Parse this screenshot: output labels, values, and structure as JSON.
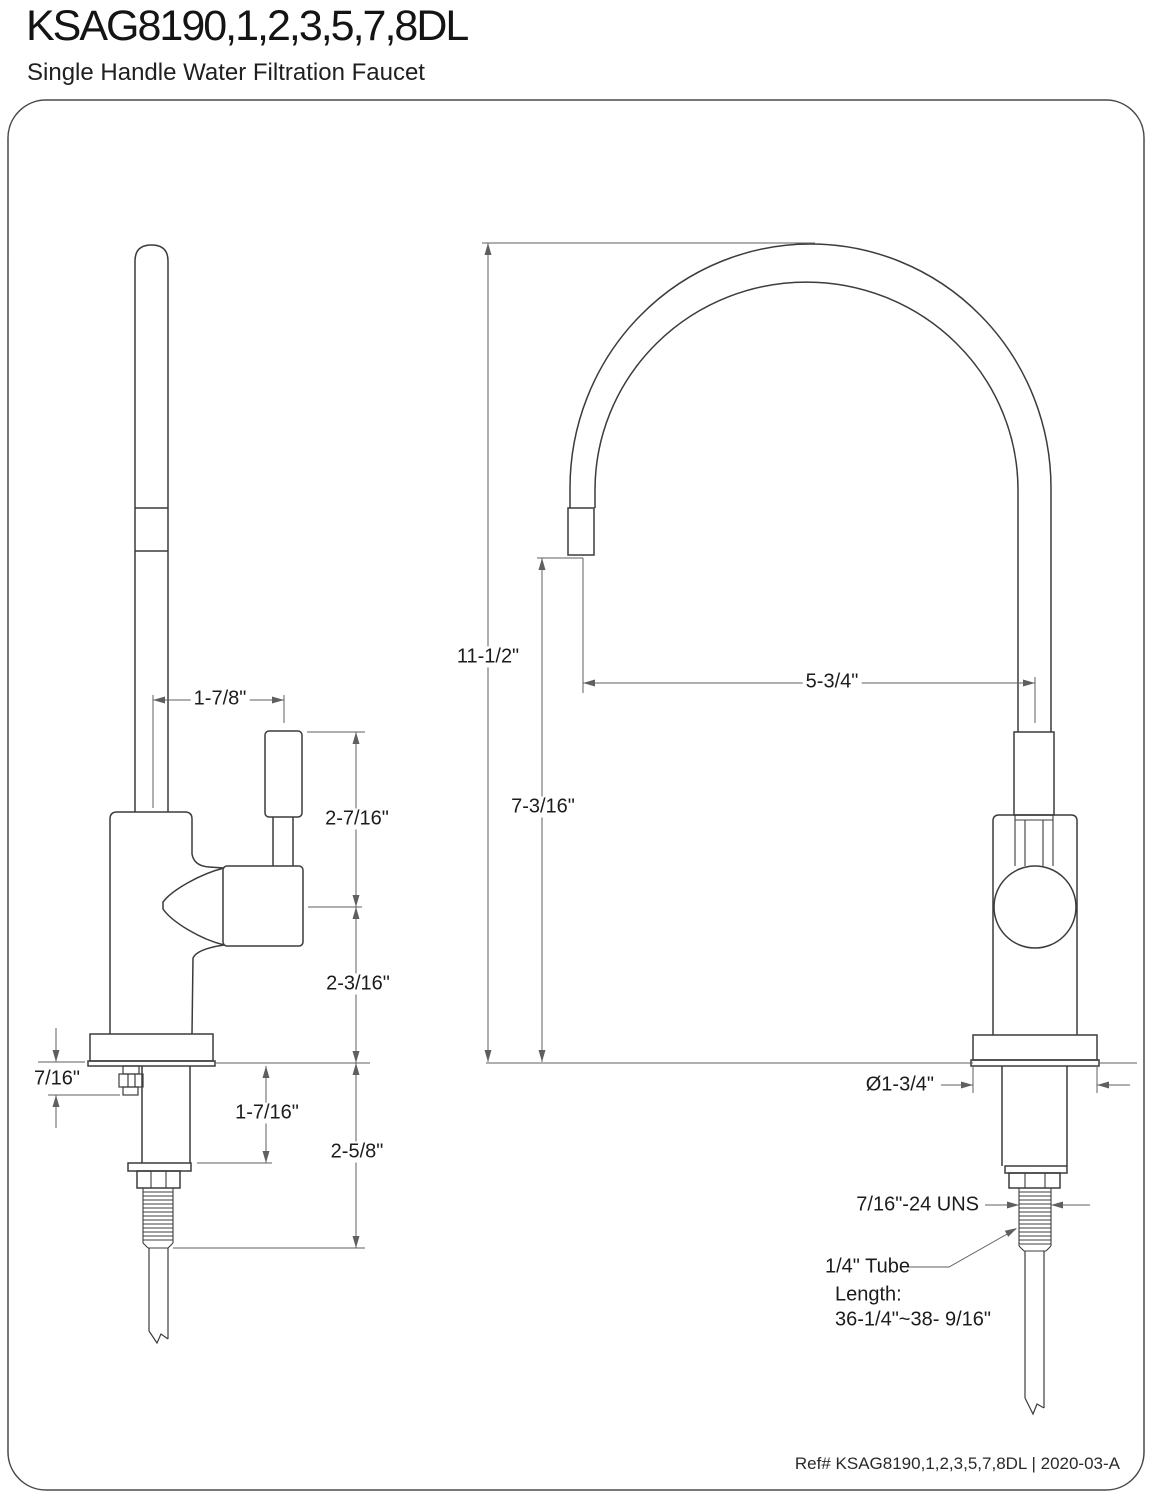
{
  "header": {
    "title": "KSAG8190,1,2,3,5,7,8DL",
    "subtitle": "Single Handle Water Filtration Faucet"
  },
  "dimensions": {
    "spout_to_handle_offset": "1-7/8\"",
    "handle_top_to_pivot": "2-7/16\"",
    "pivot_to_deck": "2-3/16\"",
    "flange_undermount_depth": "7/16\"",
    "deck_to_washer": "1-7/16\"",
    "deck_to_thread_end": "2-5/8\"",
    "overall_height": "11-1/2\"",
    "deck_to_spout_outlet": "7-3/16\"",
    "spout_reach": "5-3/4\"",
    "base_diameter": "Ø1-3/4\"",
    "shank_thread_spec": "7/16\"-24 UNS",
    "tube_note_line1": "1/4\" Tube",
    "tube_note_line2": "Length:",
    "tube_note_line3": "36-1/4\"~38- 9/16\""
  },
  "footer": {
    "reference": "Ref# KSAG8190,1,2,3,5,7,8DL | 2020-03-A"
  },
  "colors": {
    "line": "#3c3c3c",
    "dimension": "#5f5f5f",
    "text": "#1c1c1c",
    "background": "#ffffff"
  }
}
